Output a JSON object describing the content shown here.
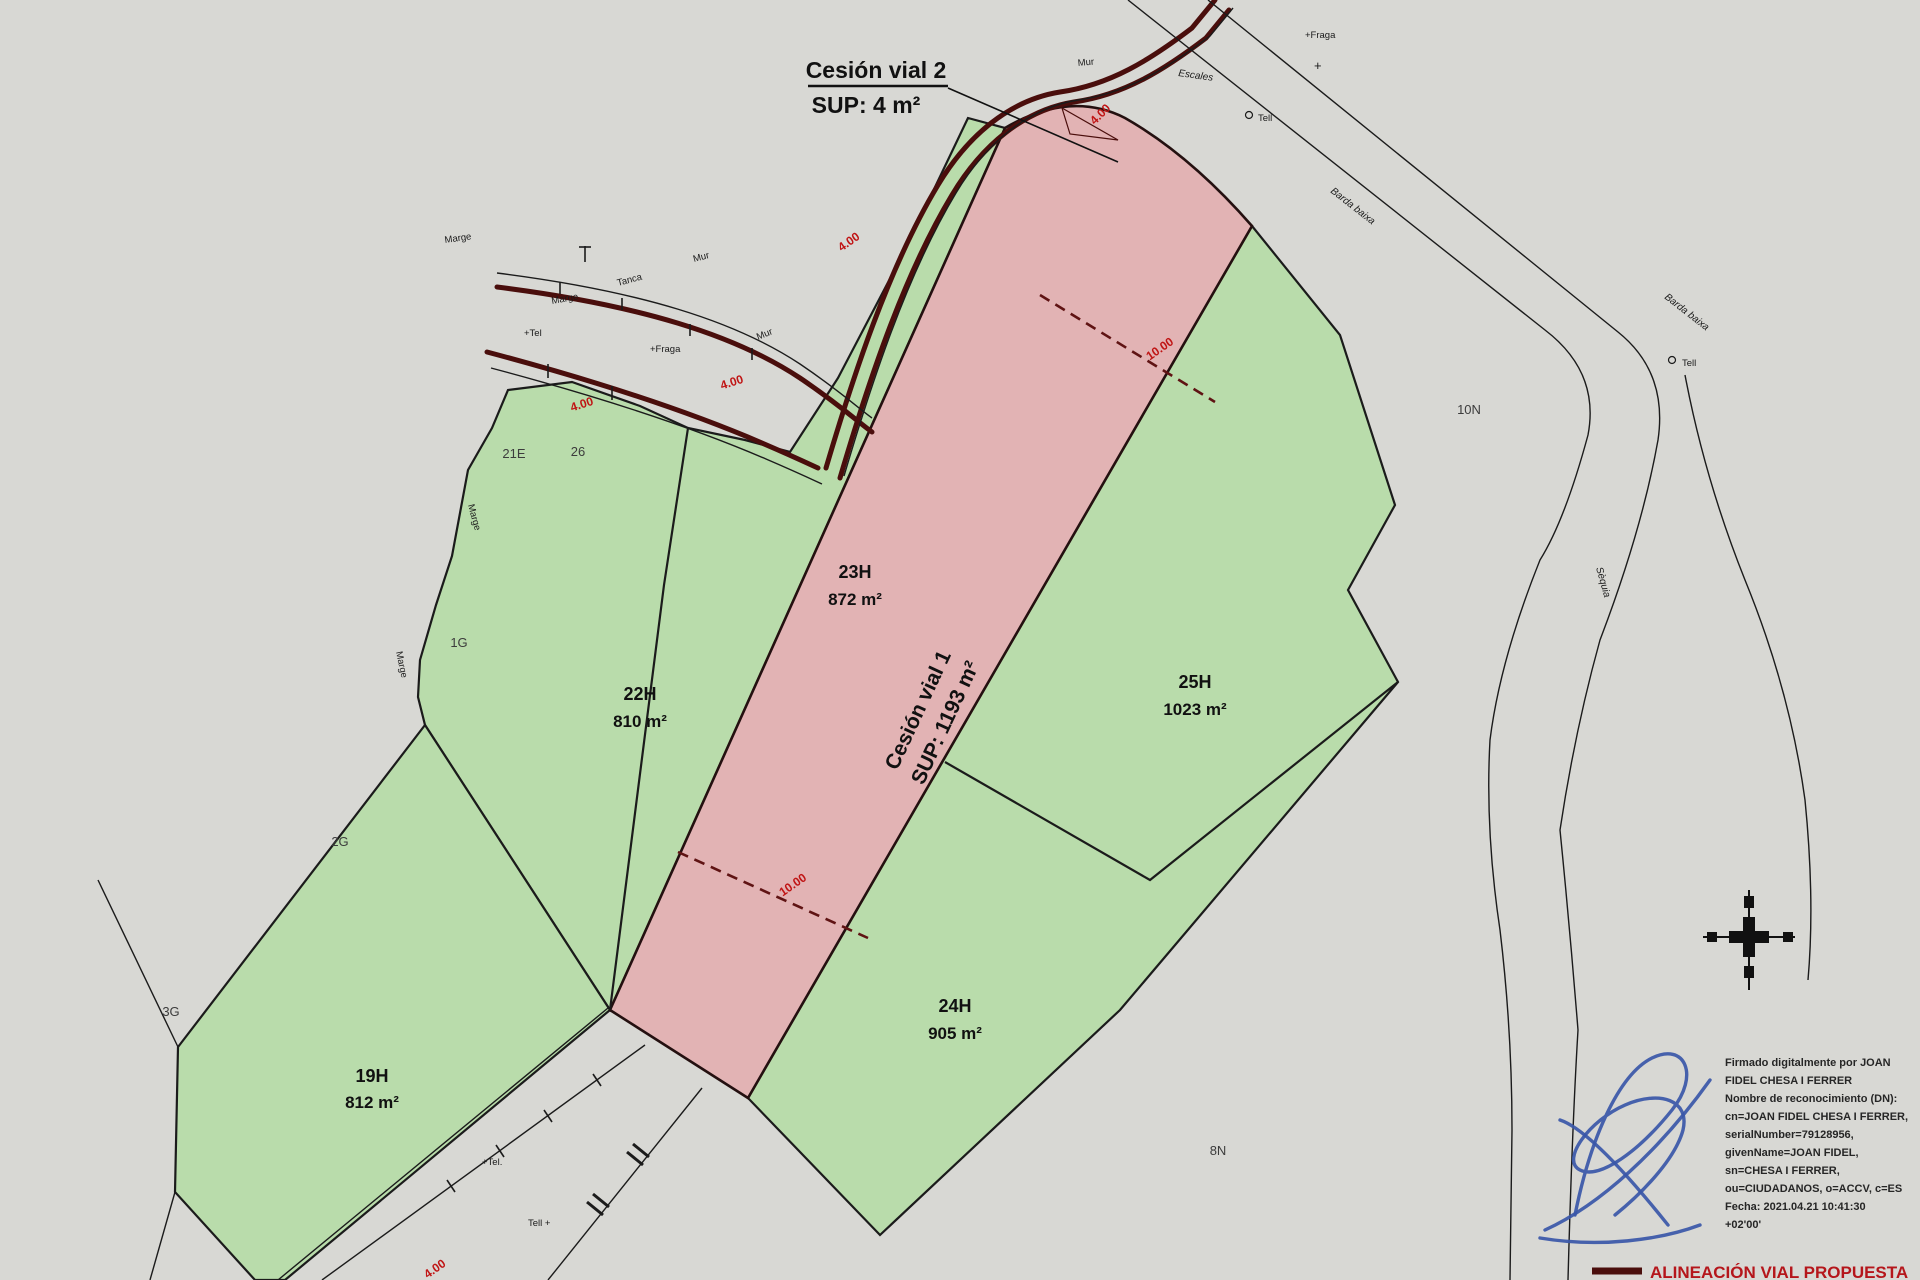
{
  "colors": {
    "background": "#d8d8d4",
    "parcel_green": "#b9dcab",
    "cession_pink": "#e2b3b4",
    "road_maroon": "#4a0e0c",
    "boundary_black": "#1b1b1b",
    "dimension_red": "#c01414",
    "signature_blue": "#3a57a8",
    "legend_red": "#b5161b"
  },
  "cession2": {
    "title": "Cesión vial 2",
    "sup": "SUP: 4 m²"
  },
  "cession1": {
    "title": "Cesión vial 1",
    "sup": "SUP: 1193 m²"
  },
  "parcels": [
    {
      "id": "19H",
      "area": "812 m²"
    },
    {
      "id": "22H",
      "area": "810 m²"
    },
    {
      "id": "23H",
      "area": "872 m²"
    },
    {
      "id": "24H",
      "area": "905 m²"
    },
    {
      "id": "25H",
      "area": "1023 m²"
    }
  ],
  "neighbors": {
    "n21e": "21E",
    "n26": "26",
    "n1g": "1G",
    "n2g": "2G",
    "n3g": "3G",
    "n10n": "10N",
    "n8n": "8N"
  },
  "dimensions": {
    "road_width": "4.00",
    "cession_width": "10.00"
  },
  "annotations": {
    "marge1": "Marge",
    "marge2": "Marge",
    "marge3": "Marge",
    "marge4": "Marge",
    "tanca": "Tanca",
    "mur1": "Mur",
    "mur2": "Mur",
    "mur3": "Mur",
    "fraga1": "+Fraga",
    "fraga2": "+Fraga",
    "tel1": "+Tel",
    "tel2": "+Tel.",
    "tell1": "Tell",
    "tell2": "Tell",
    "tell3": "Tell +",
    "plus": "+",
    "escales": "Escales",
    "sequia": "Sèquia",
    "road_name1": "Barda baixa",
    "road_name2": "Barda baixa"
  },
  "legend": {
    "label": "ALINEACIÓN VIAL PROPUESTA"
  },
  "signature": {
    "lines": [
      "Firmado digitalmente por JOAN",
      "FIDEL CHESA I FERRER",
      "Nombre de reconocimiento (DN):",
      "cn=JOAN FIDEL CHESA I FERRER,",
      "serialNumber=79128956,",
      "givenName=JOAN FIDEL,",
      "sn=CHESA I FERRER,",
      "ou=CIUDADANOS, o=ACCV, c=ES",
      "Fecha: 2021.04.21 10:41:30",
      "+02'00'"
    ]
  }
}
